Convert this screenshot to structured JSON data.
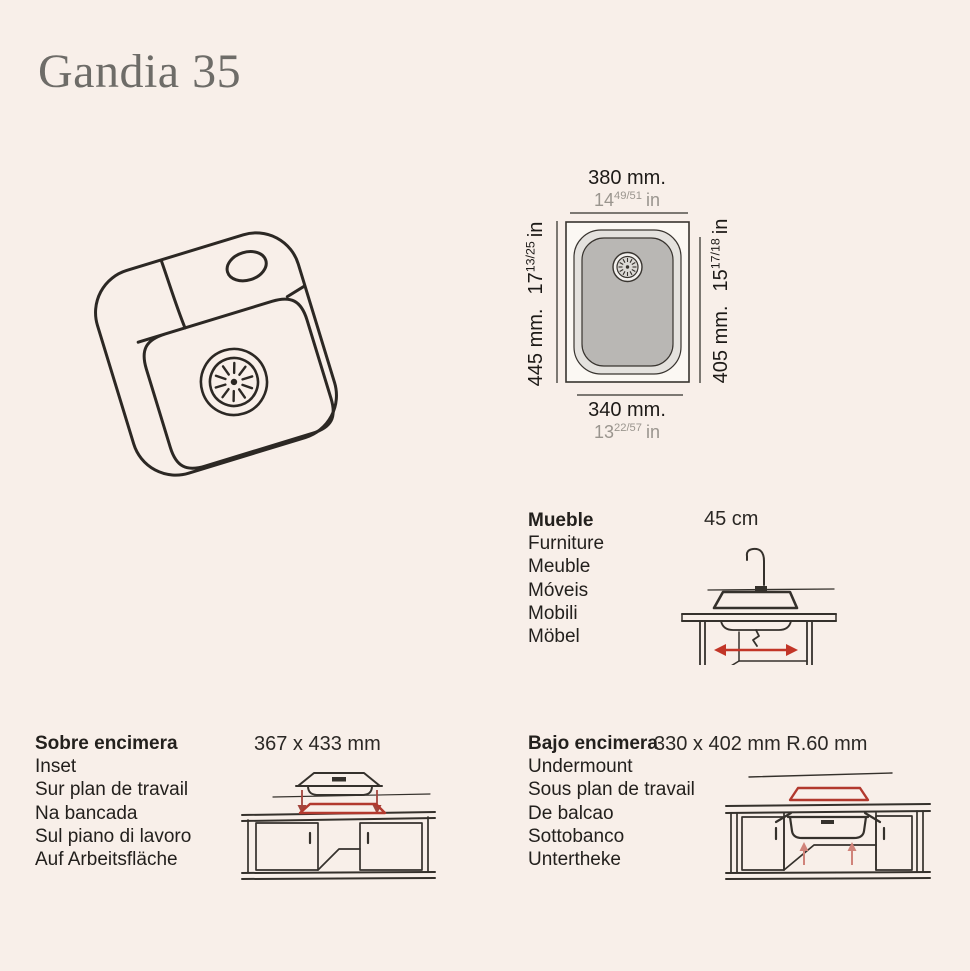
{
  "page": {
    "title": "Gandia 35"
  },
  "colors": {
    "background": "#f8efe9",
    "ink": "#2e2a26",
    "accent_red": "#b2392e",
    "title_gray": "#6e6c68",
    "muted_text": "#9a958e",
    "bowl_gray": "#b9b7b4",
    "rim_gray": "#e4e2de"
  },
  "icons": {
    "sink_3d": "sink-3d-sketch",
    "sink_top_view": "sink-top-view-diagram",
    "cabinet": "cabinet-width-diagram",
    "inset_install": "inset-installation-diagram",
    "undermount_install": "undermount-installation-diagram"
  },
  "top_view": {
    "top": {
      "mm": "380 mm.",
      "in_whole": "14",
      "in_frac": "49/51",
      "in_unit": "in"
    },
    "left": {
      "mm": "445 mm.",
      "in_whole": "17",
      "in_frac": "13/25",
      "in_unit": "in"
    },
    "right": {
      "mm": "405 mm.",
      "in_whole": "15",
      "in_frac": "17/18",
      "in_unit": "in"
    },
    "bottom": {
      "mm": "340 mm.",
      "in_whole": "13",
      "in_frac": "22/57",
      "in_unit": "in"
    }
  },
  "furniture": {
    "labels": [
      "Mueble",
      "Furniture",
      "Meuble",
      "Móveis",
      "Mobili",
      "Möbel"
    ],
    "dimension": "45 cm"
  },
  "inset": {
    "labels": [
      "Sobre encimera",
      "Inset",
      "Sur plan de travail",
      "Na bancada",
      "Sul piano di lavoro",
      "Auf Arbeitsfläche"
    ],
    "dimension": "367 x 433 mm"
  },
  "undermount": {
    "labels": [
      "Bajo encimera",
      "Undermount",
      "Sous plan de travail",
      "De balcao",
      "Sottobanco",
      "Untertheke"
    ],
    "dimension": "330 x 402 mm R.60 mm"
  }
}
